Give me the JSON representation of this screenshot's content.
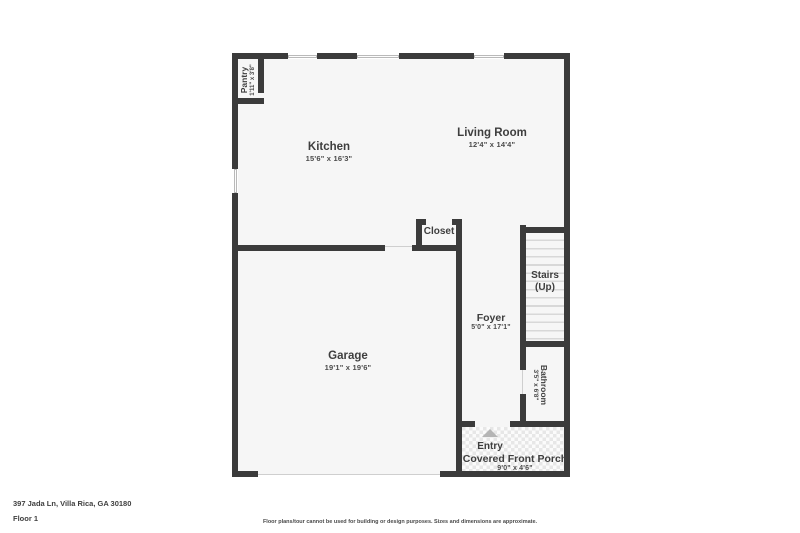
{
  "floorplan": {
    "address": "397 Jada Ln, Villa Rica, GA 30180",
    "floor_label": "Floor 1",
    "disclaimer": "Floor plans/tour cannot be used for building or design purposes. Sizes and dimensions are approximate.",
    "rooms": {
      "living_room": {
        "name": "Living Room",
        "dims": "12'4\" x 14'4\""
      },
      "kitchen": {
        "name": "Kitchen",
        "dims": "15'6\" x 16'3\""
      },
      "pantry": {
        "name": "Pantry",
        "dims": "1'11\" x 3'8\""
      },
      "closet": {
        "name": "Closet"
      },
      "stairs": {
        "name": "Stairs",
        "direction": "(Up)"
      },
      "foyer": {
        "name": "Foyer",
        "dims": "5'0\" x 17'1\""
      },
      "garage": {
        "name": "Garage",
        "dims": "19'1\" x 19'6\""
      },
      "bathroom": {
        "name": "Bathroom",
        "dims": "3'5\" x 6'8\""
      },
      "entry": {
        "name": "Entry"
      },
      "porch": {
        "name": "Covered Front Porch",
        "dims": "9'0\" x 4'6\""
      }
    },
    "icons": {
      "entry_arrow": "triangle-up"
    },
    "colors": {
      "wall": "#3b3b3b",
      "room_fill": "#f6f6f6",
      "text": "#3e3e3e",
      "stair_tread": "#d8d8d8",
      "porch_tile": "#e7e7e7",
      "entry_arrow": "#b5b5b5"
    }
  }
}
